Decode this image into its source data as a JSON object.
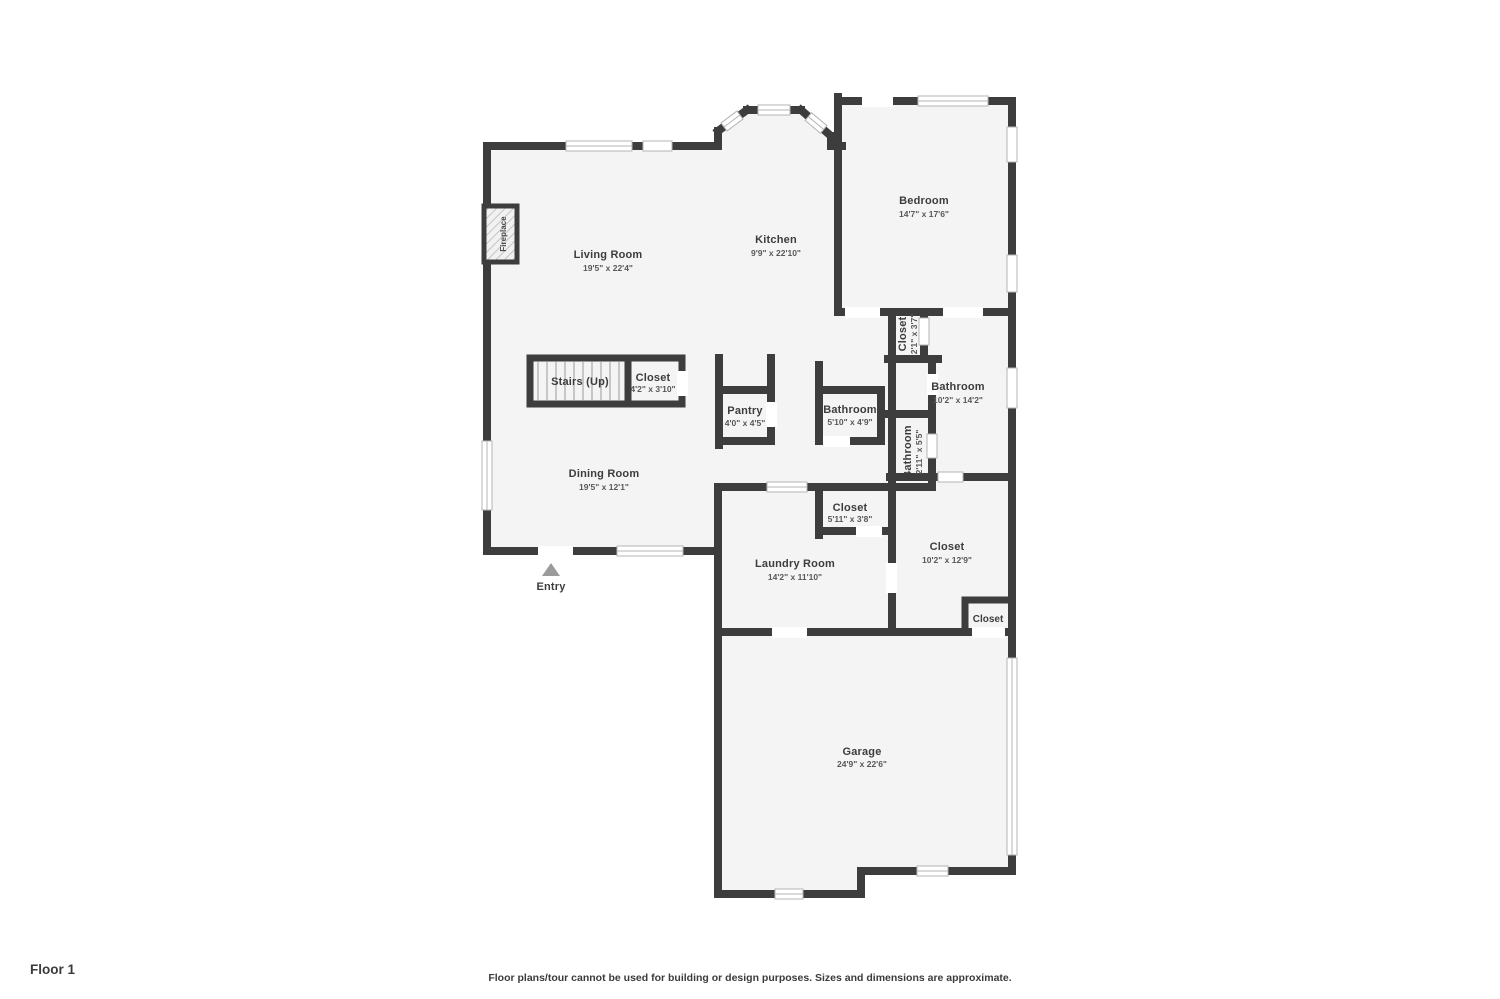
{
  "plan": {
    "floor_label": "Floor 1",
    "disclaimer": "Floor plans/tour cannot be used for building or design purposes. Sizes and dimensions are approximate."
  },
  "colors": {
    "wall": "#3d3d3d",
    "floor": "#f4f4f4",
    "window": "#ffffff",
    "window_border": "#b5b5b5",
    "room_text": "#3d3d3d",
    "dim_text": "#585858",
    "entry_arrow": "#9b9b9b"
  },
  "rooms": {
    "living": {
      "name": "Living Room",
      "dims": "19'5\" x 22'4\""
    },
    "kitchen": {
      "name": "Kitchen",
      "dims": "9'9\" x 22'10\""
    },
    "bedroom": {
      "name": "Bedroom",
      "dims": "14'7\" x 17'6\""
    },
    "hall_closet": {
      "name": "Closet",
      "dims": "2'1\" x 3'7\""
    },
    "main_bathroom": {
      "name": "Bathroom",
      "dims": "10'2\" x 14'2\""
    },
    "pantry": {
      "name": "Pantry",
      "dims": "4'0\" x 4'5\""
    },
    "small_bathroom": {
      "name": "Bathroom",
      "dims": "5'10\" x 4'9\""
    },
    "wc_bathroom": {
      "name": "Bathroom",
      "dims": "2'11\" x 5'5\""
    },
    "stairs_closet": {
      "name": "Closet",
      "dims": "4'2\" x 3'10\""
    },
    "dining": {
      "name": "Dining Room",
      "dims": "19'5\" x 12'1\""
    },
    "laundry_closet": {
      "name": "Closet",
      "dims": "5'11\" x 3'8\""
    },
    "laundry": {
      "name": "Laundry Room",
      "dims": "14'2\" x 11'10\""
    },
    "big_closet": {
      "name": "Closet",
      "dims": "10'2\" x 12'9\""
    },
    "garage_closet": {
      "name": "Closet"
    },
    "garage": {
      "name": "Garage",
      "dims": "24'9\" x 22'6\""
    }
  },
  "features": {
    "fireplace": "Fireplace",
    "stairs": "Stairs (Up)",
    "entry": "Entry"
  }
}
